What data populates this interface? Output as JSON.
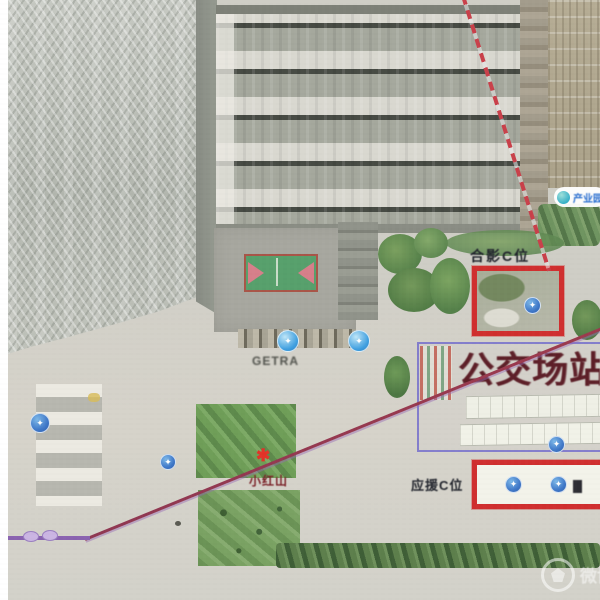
{
  "page": {
    "kind": "annotated aerial satellite map photo",
    "watermark_text": "微博"
  },
  "map": {
    "title": "公交场站",
    "annotations": {
      "top_red_box_label": "合影C位",
      "bottom_red_box_label": "应援C位",
      "plaza_label": "GETRA",
      "red_poi_label": "小红山",
      "poi_pill_label": "产业园"
    },
    "icons": {
      "location_marker": "✦",
      "red_poi_icon": "✱"
    },
    "colors": {
      "highlight_box": "#d02f2f",
      "dashed_route_line": "#c9404a",
      "boundary_rect": "#7670cd",
      "metro_line": "#8a63b0",
      "marker_blue": "#3e77c8",
      "title_color": "#5d1f28"
    }
  }
}
